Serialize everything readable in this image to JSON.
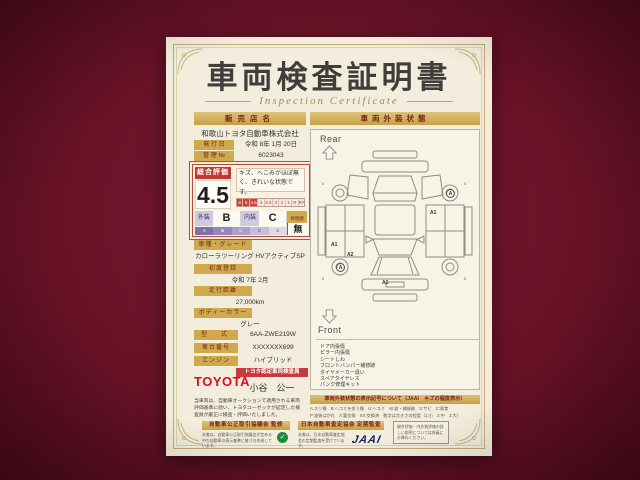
{
  "certificate": {
    "title": "車両検査証明書",
    "subtitle": "Inspection Certificate",
    "left": {
      "dealer_header": "販売店名",
      "dealer_name": "和歌山トヨタ自動車株式会社",
      "issue_date_label": "発 行 日",
      "issue_date": "令和 8年 1月 20日",
      "control_no_label": "管 理 №",
      "control_no": "6023043",
      "rating": {
        "label": "総合評価",
        "score": "4.5",
        "comment": "キズ、ヘこみがほぼ無く、きれいな状態です。",
        "scale": [
          "S",
          "5",
          "4.5",
          "4",
          "3.5",
          "3",
          "2",
          "1",
          "R",
          "RA"
        ],
        "exterior_label": "外装",
        "exterior_grade": "B",
        "interior_label": "内装",
        "interior_grade": "C",
        "repair_label": "修復歴",
        "repair_value": "無",
        "grade_scale": [
          "A",
          "B",
          "C",
          "D",
          "E"
        ]
      },
      "fields": [
        {
          "label": "車種・グレード",
          "value": "カローラツーリング HVアクティブSP"
        },
        {
          "label": "初度登録",
          "value": "令和 7年 2月"
        },
        {
          "label": "走行距離",
          "value": "27,000km"
        },
        {
          "label": "ボディーカラー",
          "value": "グレー"
        },
        {
          "label": "型　式",
          "value": "6AA-ZWE219W"
        },
        {
          "label": "車台番号",
          "value": "XXXXXXX699"
        },
        {
          "label": "エンジン",
          "value": "ハイブリッド"
        }
      ],
      "inspector": {
        "brand": "TOYOTA",
        "badge": "トヨタ認定車両検査員",
        "name": "小谷　公一"
      },
      "disclaimer": "当車両は、自動車オークションで適用される車両評価基準に倣い、トヨタユーゼックが認定した検査員が厳正に検査・評価いたしました。"
    },
    "right": {
      "header": "車両外装状態",
      "rear_label": "Rear",
      "front_label": "Front",
      "marks": [
        {
          "label": "A1"
        },
        {
          "label": "A2"
        },
        {
          "label": "A1"
        },
        {
          "label": "A"
        },
        {
          "label": "A"
        },
        {
          "label": "A1"
        }
      ],
      "wheel_mark": "6",
      "notes": [
        "ドア内張傷",
        "ピラー内張傷",
        "シートしわ",
        "フロントバンパー補修跡",
        "タイヤメーカー違い",
        "スペアタイヤレス",
        "パンク修理キット"
      ],
      "legend_header": "車両外装状態の表示記号について（JAAI　キズの程度表示）",
      "legend_lines": [
        "A:スリ傷　B:ヘコミを伴う傷　U:ヘコミ　W:波・補修跡　S:サビ　C:腐食",
        "P:塗装はがれ　X:要交換　XX:交換済　数字は大きさの程度（1:小　2:中　3:大）"
      ]
    },
    "footer": {
      "council_header": "自動車公正取引協議会 監修",
      "council_note": "本書は、自動車公正取引協議会が定める中古自動車の表示基準に基づき作成しています。",
      "jaai_header": "日本自動車査定協会 定期監査",
      "jaai_note": "本書は、日本自動車査定協会の定期監査を受けています。",
      "jaai_logo": "JAAI",
      "notice": "総合評価・内外装評価の詳しい説明については係員にお尋ねください。"
    }
  }
}
